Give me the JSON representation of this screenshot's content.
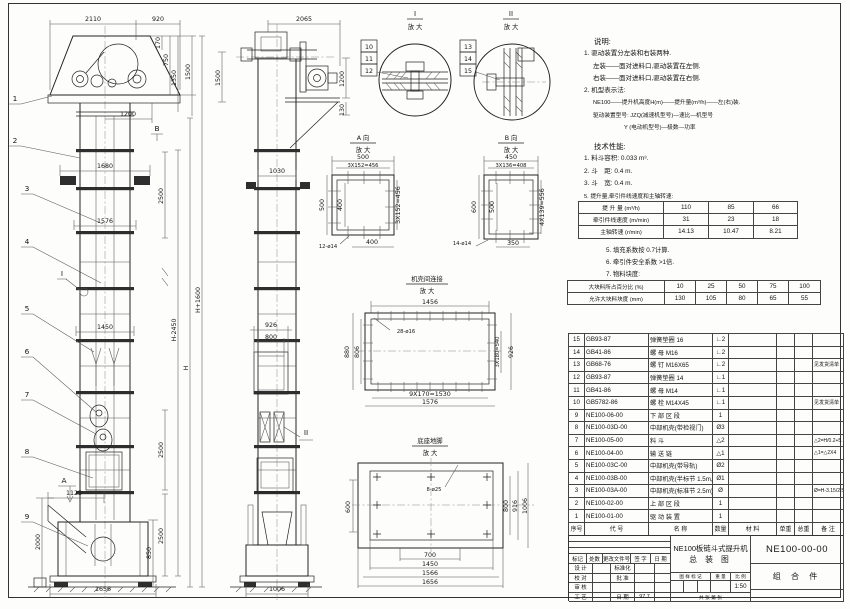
{
  "drawing": {
    "front": {
      "dims": {
        "w2110": "2110",
        "w920": "920",
        "h170": "170",
        "h750": "750",
        "h1350": "1350",
        "h1500": "1500",
        "w1200": "1200",
        "w1680": "1680",
        "w1576": "1576",
        "w1450": "1450",
        "s2500a": "2500",
        "s2500b": "2500",
        "s2500c": "2500",
        "w1125": "1125",
        "h2000": "2000",
        "h850": "850",
        "w1656": "1656",
        "hH": "H",
        "hHm": "H-2450",
        "hHp": "H+1600"
      },
      "balloons": [
        "1",
        "2",
        "3",
        "4",
        "5",
        "6",
        "7",
        "8",
        "9"
      ],
      "marker_a": "A",
      "marker_b": "B",
      "marker_i": "I"
    },
    "side": {
      "dims": {
        "w2065": "2065",
        "h1500": "1500",
        "h1200": "1200",
        "h130": "130",
        "w1030": "1030",
        "w926": "926",
        "w800": "800",
        "w1006": "1006"
      },
      "marker_ii": "II"
    },
    "detail_i": {
      "title": "I",
      "zoom": "放 大",
      "labels": [
        "10",
        "11",
        "12"
      ]
    },
    "detail_ii": {
      "title": "II",
      "zoom": "放 大",
      "labels": [
        "13",
        "14",
        "15"
      ]
    },
    "detail_a": {
      "title": "A 向",
      "zoom": "放 大",
      "top1": "500",
      "top2": "3X152=456",
      "left": "500",
      "left_in": "400",
      "bottom": "400",
      "right": "3X152=456",
      "holes": "12-ø14"
    },
    "detail_b": {
      "title": "B 向",
      "zoom": "放 大",
      "top1": "450",
      "top2": "3X136=408",
      "left": "600",
      "left_in": "500",
      "bottom": "350",
      "right": "4X139=556",
      "holes": "14-ø14"
    },
    "joint": {
      "title": "机壳间连接",
      "zoom": "放 大",
      "top": "1456",
      "holes": "28-ø16",
      "left": "880",
      "left_in": "806",
      "right_in": "3X180=540",
      "right": "926",
      "bot1": "9X170=1530",
      "bot2": "1576"
    },
    "base": {
      "title": "底座地脚",
      "zoom": "放 大",
      "holes": "8-ø25",
      "left": "600",
      "r1": "800",
      "r2": "916",
      "r3": "1006",
      "b1": "700",
      "b2": "1450",
      "b3": "1566",
      "b4": "1656"
    }
  },
  "notes": {
    "heading": "说明:",
    "lines": [
      "1. 驱动装置分左装和右装两种.",
      "左装——面对进料口,驱动装置在左侧.",
      "右装——面对进料口,驱动装置在右侧.",
      "2. 机型表示法:",
      "NE100——提升机高度H(m)——提升量(m³/h)——左(右)装.",
      "驱动装置型号: JZQ(减速机型号)—速比—机型号",
      "Y (电动机型号)—极数—功率"
    ]
  },
  "specs": {
    "heading": "技术性能:",
    "items": [
      "1. 料斗容积: 0.033 m³.",
      "2. 斗　距: 0.4 m.",
      "3. 斗　宽: 0.4 m.",
      "5. 提升量,牵引件线速度和主轴转速:"
    ],
    "table1": [
      {
        "label": "提 升 量",
        "unit": "(m³/h)",
        "v": [
          "110",
          "85",
          "66"
        ]
      },
      {
        "label": "牵引件线速度",
        "unit": "(m/min)",
        "v": [
          "31",
          "23",
          "18"
        ]
      },
      {
        "label": "主轴转速",
        "unit": "(r/min)",
        "v": [
          "14.13",
          "10.47",
          "8.21"
        ]
      }
    ],
    "items2": [
      "5. 填充系数按 0.7计算.",
      "6. 牵引件安全系数 >1倍.",
      "7. 物料块度:"
    ],
    "table2": [
      {
        "label": "大块料所占百分比 (%)",
        "v": [
          "10",
          "25",
          "50",
          "75",
          "100"
        ]
      },
      {
        "label": "允许大块料块度 (mm)",
        "v": [
          "130",
          "105",
          "80",
          "65",
          "55"
        ]
      }
    ]
  },
  "bom": {
    "header": [
      "序号",
      "代  号",
      "名  称",
      "数量",
      "材  料",
      "单重",
      "总重",
      "备  注"
    ],
    "rows": [
      {
        "no": "15",
        "code": "GB93-87",
        "name": "弹簧垫圈  16",
        "qty": "∟2",
        "remark": ""
      },
      {
        "no": "14",
        "code": "GB41-86",
        "name": "螺  母  M16",
        "qty": "∟2",
        "remark": ""
      },
      {
        "no": "13",
        "code": "GB68-76",
        "name": "螺  钉  M16X65",
        "qty": "∟2",
        "remark": "见发货清单"
      },
      {
        "no": "12",
        "code": "GB93-87",
        "name": "弹簧垫圈  14",
        "qty": "∟1",
        "remark": ""
      },
      {
        "no": "11",
        "code": "GB41-86",
        "name": "螺  母  M14",
        "qty": "∟1",
        "remark": ""
      },
      {
        "no": "10",
        "code": "GB5782-86",
        "name": "螺  栓  M14X45",
        "qty": "∟1",
        "remark": "见发货清单"
      },
      {
        "no": "9",
        "code": "NE100-06-00",
        "name": "下 部 区 段",
        "qty": "1",
        "remark": ""
      },
      {
        "no": "8",
        "code": "NE100-03D-00",
        "name": "中部机壳(带检视门)",
        "qty": "Ø3",
        "remark": ""
      },
      {
        "no": "7",
        "code": "NE100-05-00",
        "name": "料  斗",
        "qty": "△2",
        "remark": "△2=H/0.2+5.75"
      },
      {
        "no": "6",
        "code": "NE100-04-00",
        "name": "输 送 链",
        "qty": "△1",
        "remark": "△1=△2X4"
      },
      {
        "no": "5",
        "code": "NE100-03C-00",
        "name": "中部机壳(带导轨)",
        "qty": "Ø2",
        "remark": ""
      },
      {
        "no": "4",
        "code": "NE100-03B-00",
        "name": "中部机壳(半标节 1.5m,1m)",
        "qty": "Ø1",
        "remark": ""
      },
      {
        "no": "3",
        "code": "NE100-03A-00",
        "name": "中部机壳(标准节 2.5m)",
        "qty": "Ø",
        "remark": "Ø=H-3.15/2.5"
      },
      {
        "no": "2",
        "code": "NE100-02-00",
        "name": "上 部 区 段",
        "qty": "1",
        "remark": ""
      },
      {
        "no": "1",
        "code": "NE100-01-00",
        "name": "驱 动 装 置",
        "qty": "1",
        "remark": ""
      }
    ]
  },
  "title_block": {
    "rev": [
      "标记",
      "处数",
      "更改文件号",
      "签  字",
      "日  期"
    ],
    "design": "设  计",
    "standardization": "标准化",
    "check": "校  对",
    "approve": "批  准",
    "audit": "审  核",
    "process": "工  艺",
    "date_label": "日  期",
    "date_value": "97.7",
    "title1": "NE100板链斗式提升机",
    "title2": "总  装  图",
    "stamp": "图 样 标 记",
    "weight": "重  量",
    "scale_label": "比  例",
    "scale": "1:50",
    "sheets": "共  张  第  张",
    "drawing_no": "NE100-00-00",
    "assembly": "组 合 件"
  }
}
